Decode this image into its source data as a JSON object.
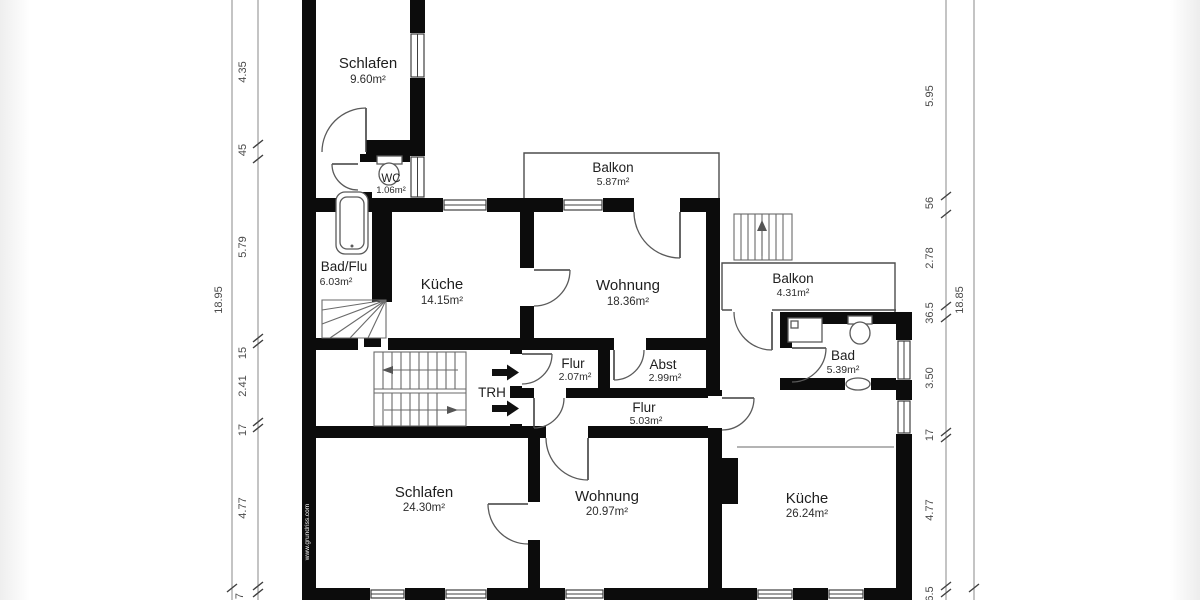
{
  "rooms": [
    {
      "name": "Schlafen",
      "area": "9.60m²"
    },
    {
      "name": "WC",
      "area": "1.06m²"
    },
    {
      "name": "Bad/Flu",
      "area": "6.03m²"
    },
    {
      "name": "Küche",
      "area": "14.15m²"
    },
    {
      "name": "Wohnung",
      "area": "18.36m²"
    },
    {
      "name": "Balkon",
      "area": "5.87m²"
    },
    {
      "name": "Balkon",
      "area": "4.31m²"
    },
    {
      "name": "Bad",
      "area": "5.39m²"
    },
    {
      "name": "Flur",
      "area": "2.07m²"
    },
    {
      "name": "Abst",
      "area": "2.99m²"
    },
    {
      "name": "TRH",
      "area": ""
    },
    {
      "name": "Flur",
      "area": "5.03m²"
    },
    {
      "name": "Schlafen",
      "area": "24.30m²"
    },
    {
      "name": "Wohnung",
      "area": "20.97m²"
    },
    {
      "name": "Küche",
      "area": "26.24m²"
    }
  ],
  "dimensions": {
    "left_outer": "18.95",
    "left_chain": [
      "4.35",
      "45",
      "5.79",
      "15",
      "2.41",
      "17",
      "4.77",
      "7"
    ],
    "right_chain": [
      "5.95",
      "56",
      "2.78",
      "36.5",
      "3.50",
      "17",
      "4.77",
      "6.5"
    ],
    "right_outer": "18.85"
  },
  "watermark": "www.grundriss.com",
  "colors": {
    "wall": "#0c0c0c",
    "line": "#4d4d4d",
    "dim_text": "#4a4a4a",
    "background": "#ffffff"
  }
}
